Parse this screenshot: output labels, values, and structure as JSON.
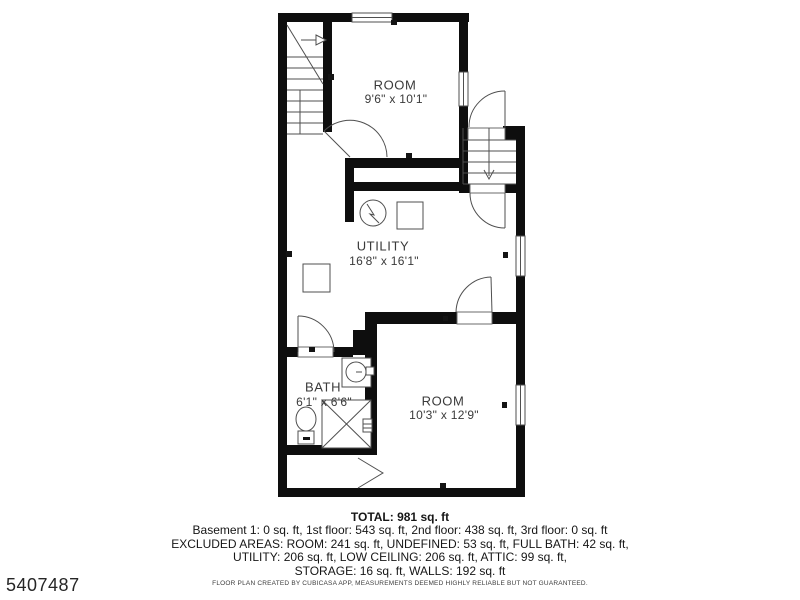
{
  "plan": {
    "type": "floor-plan",
    "colors": {
      "wall": "#0e0e0e",
      "lines": "#4f4f4f",
      "label_text": "#3a3a3a",
      "background": "#ffffff"
    },
    "rooms": [
      {
        "id": "room-top",
        "name": "ROOM",
        "dims": "9'6\" x 10'1\""
      },
      {
        "id": "utility",
        "name": "UTILITY",
        "dims": "16'8\" x 16'1\""
      },
      {
        "id": "bath",
        "name": "BATH",
        "dims": "6'1\" x 6'6\""
      },
      {
        "id": "room-bottom",
        "name": "ROOM",
        "dims": "10'3\" x 12'9\""
      }
    ],
    "fixtures": [
      "stairs-up-icon",
      "stairs-down-icon",
      "water-heater-icon",
      "appliance-icon",
      "appliance-icon",
      "sink-icon",
      "toilet-icon",
      "shower-icon",
      "window-icon",
      "window-icon",
      "window-icon",
      "window-icon",
      "door-icon",
      "door-icon",
      "door-icon",
      "door-icon",
      "door-icon",
      "access-chevron-icon"
    ]
  },
  "summary": {
    "total": "TOTAL: 981 sq. ft",
    "lines": [
      "Basement 1: 0 sq. ft, 1st floor: 543 sq. ft, 2nd floor: 438 sq. ft, 3rd floor: 0 sq. ft",
      "EXCLUDED AREAS: ROOM: 241 sq. ft, UNDEFINED: 53 sq. ft, FULL BATH: 42 sq. ft,",
      "UTILITY: 206 sq. ft, LOW CEILING: 206 sq. ft, ATTIC: 99 sq. ft,",
      "STORAGE: 16 sq. ft, WALLS: 192 sq. ft"
    ]
  },
  "footer": {
    "disclaimer": "FLOOR PLAN CREATED BY CUBICASA APP, MEASUREMENTS DEEMED HIGHLY RELIABLE BUT NOT GUARANTEED."
  },
  "watermark": {
    "id": "5407487"
  }
}
